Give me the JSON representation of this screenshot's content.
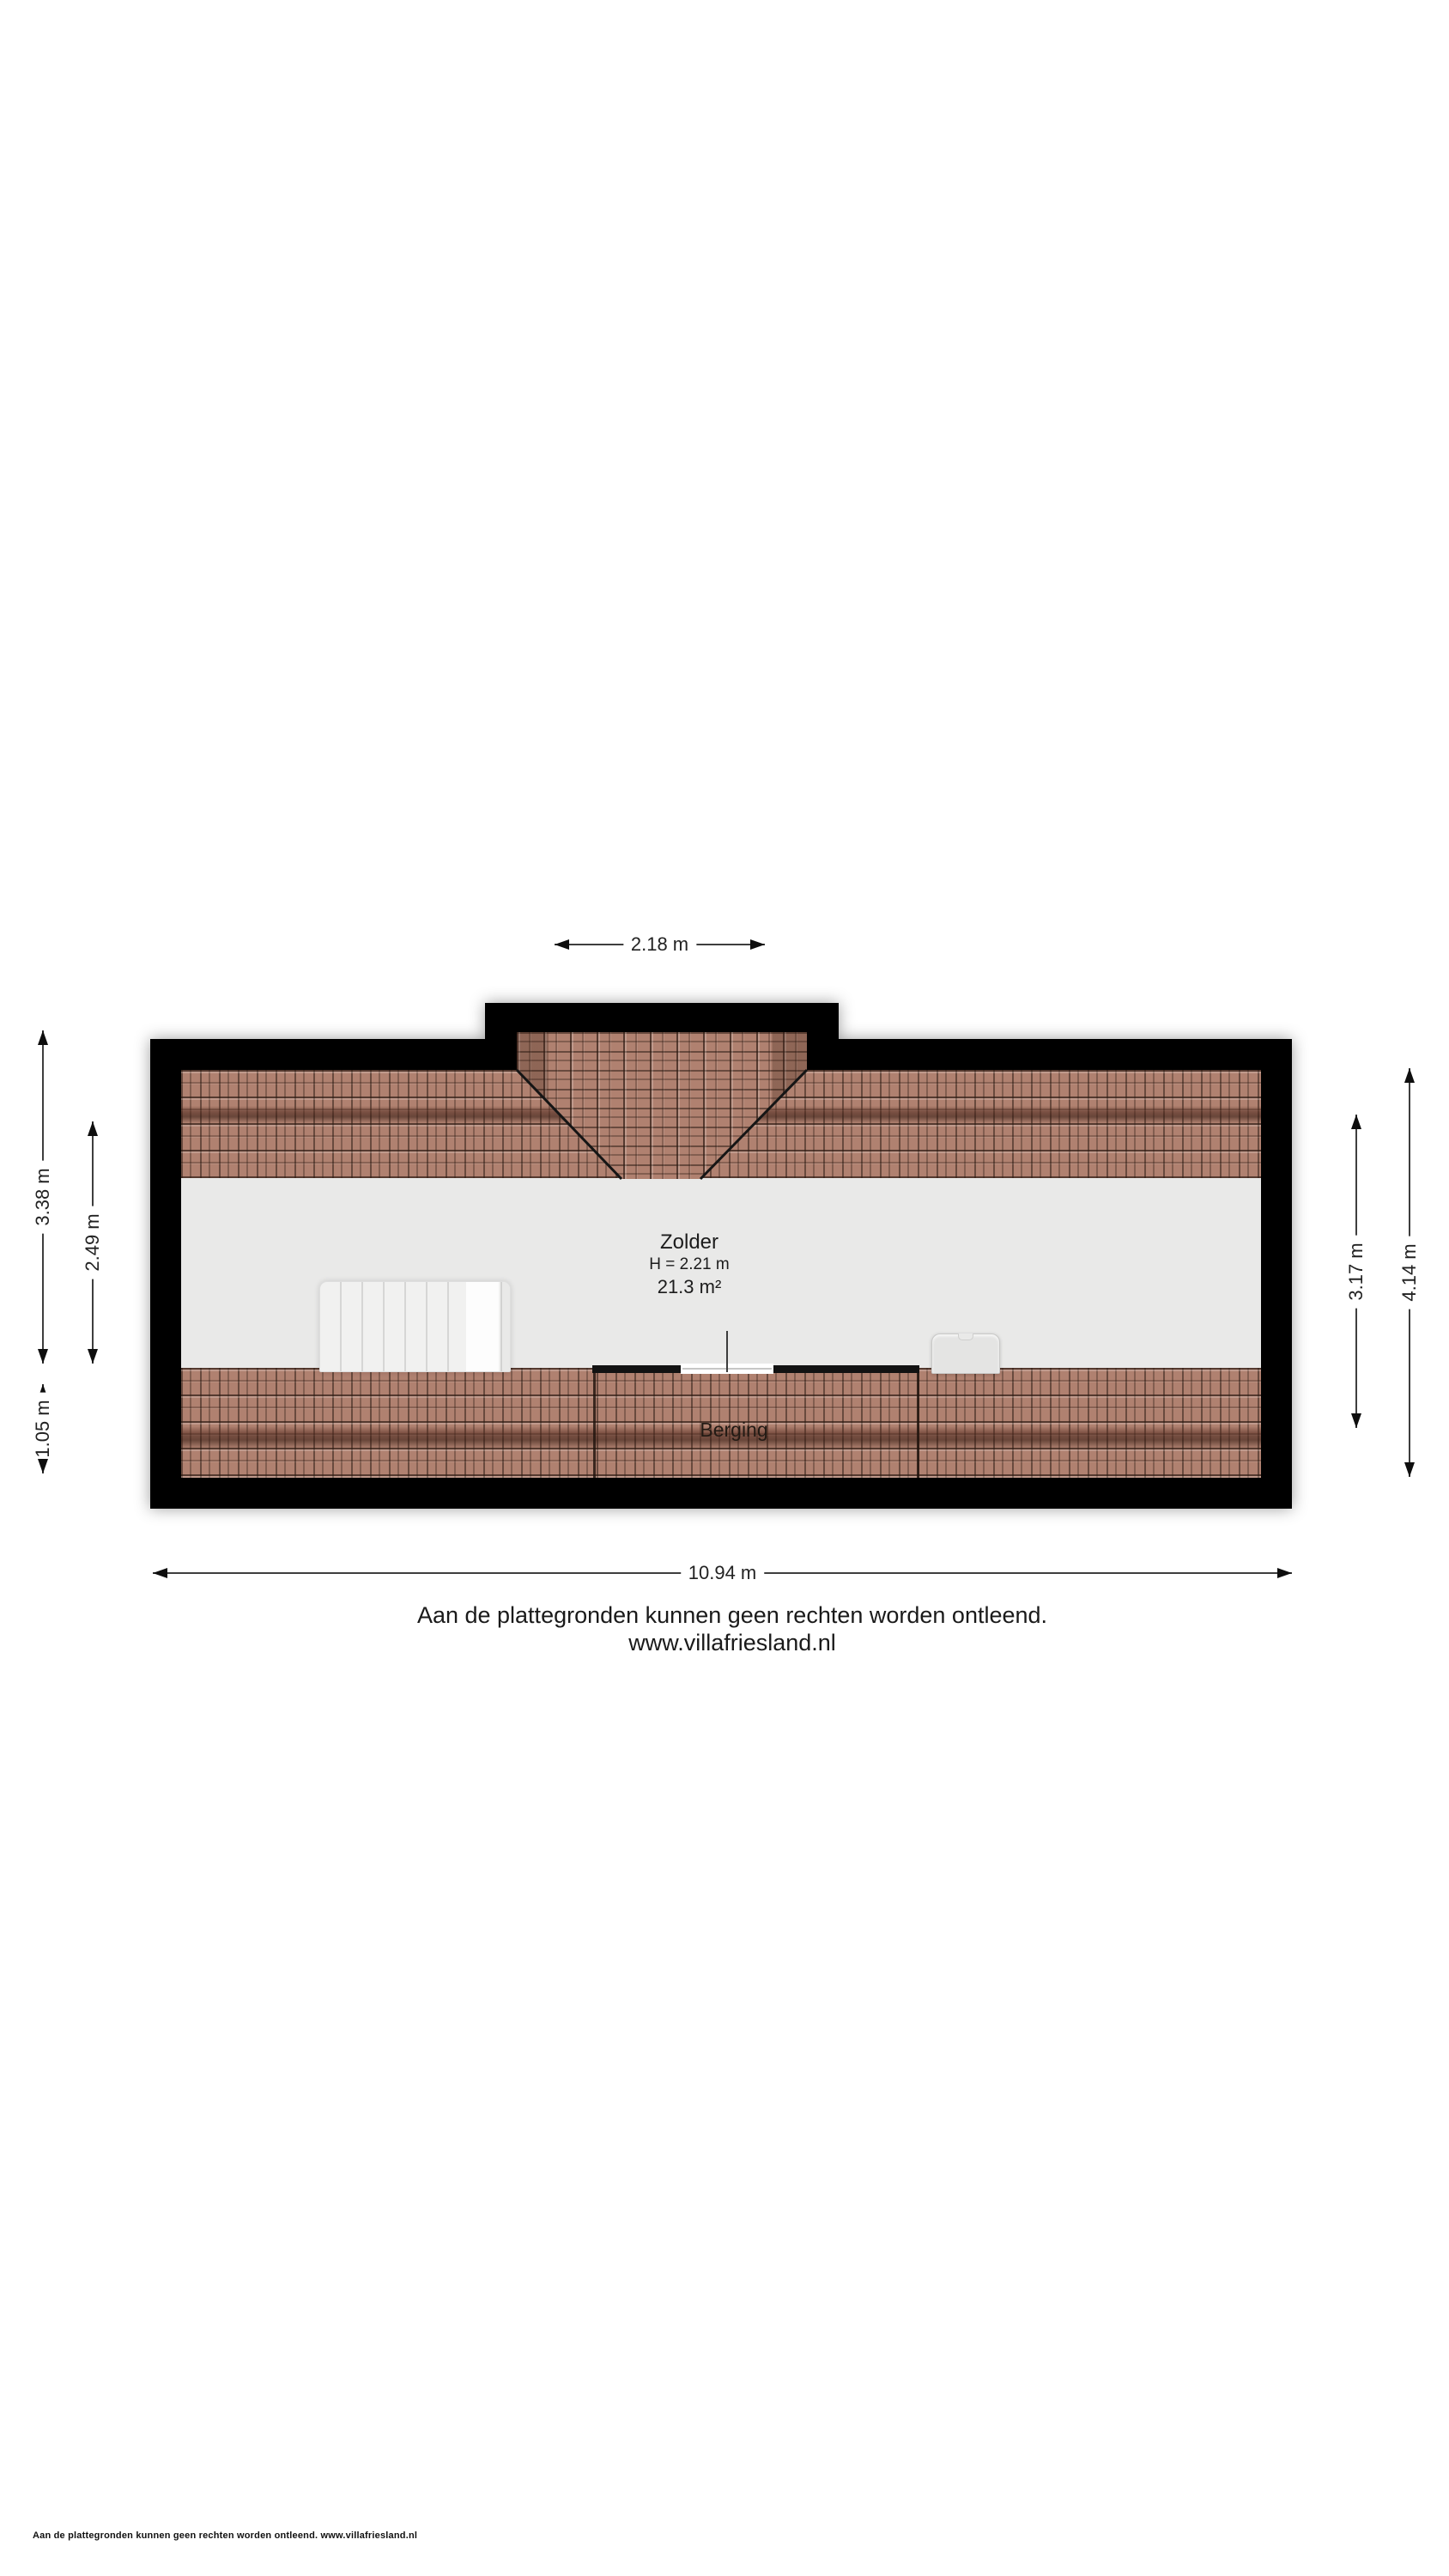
{
  "plan": {
    "rooms": {
      "zolder": {
        "name": "Zolder",
        "height_label": "H = 2.21 m",
        "area_label": "21.3 m²"
      },
      "berging": {
        "name": "Berging"
      }
    },
    "dimensions": {
      "top": "2.18 m",
      "left_outer": "3.38 m",
      "left_inner": "2.49 m",
      "left_lower": "1.05 m",
      "right_inner": "3.17 m",
      "right_outer": "4.14 m",
      "bottom": "10.94 m"
    },
    "colors": {
      "wall": "#000000",
      "tile_base": "#b08170",
      "tile_line": "#2e1c14",
      "room_floor": "#e9e9e8",
      "ridge_shadow": "#542c20"
    }
  },
  "disclaimer": {
    "line1": "Aan de plattegronden kunnen geen rechten worden ontleend.",
    "line2": "www.villafriesland.nl"
  },
  "footer": {
    "text": "Aan de plattegronden kunnen geen rechten worden ontleend. www.villafriesland.nl"
  }
}
